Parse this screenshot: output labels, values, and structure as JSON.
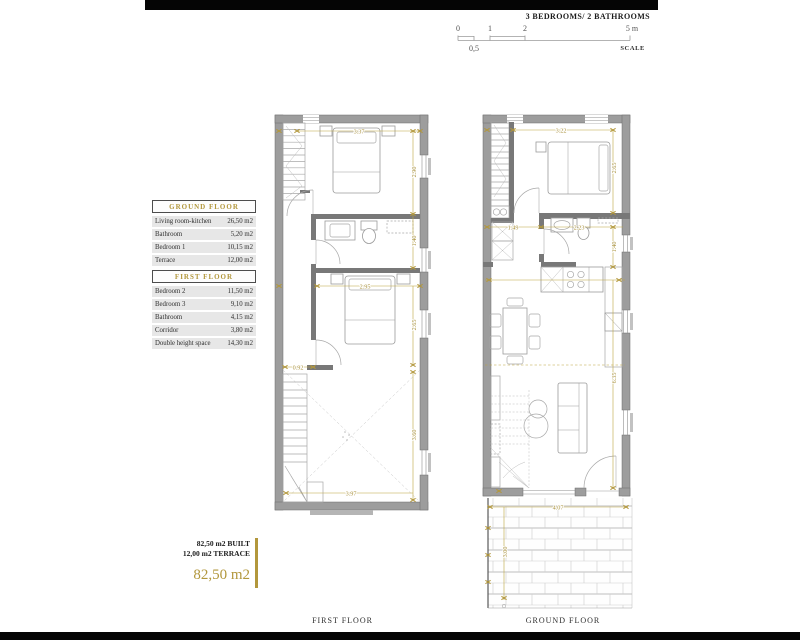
{
  "header": {
    "title": "3 BEDROOMS/ 2 BATHROOMS",
    "scale": {
      "t0": "0",
      "t1": "1",
      "t2": "2",
      "t5": "5 m",
      "half": "0,5",
      "label": "SCALE"
    }
  },
  "area_tables": [
    {
      "title": "GROUND FLOOR",
      "rows": [
        {
          "room": "Living room-kitchen",
          "area": "26,50 m2"
        },
        {
          "room": "Bathroom",
          "area": "5,20 m2"
        },
        {
          "room": "Bedroom 1",
          "area": "10,15 m2"
        },
        {
          "room": "Terrace",
          "area": "12,00 m2"
        }
      ]
    },
    {
      "title": "FIRST FLOOR",
      "rows": [
        {
          "room": "Bedroom 2",
          "area": "11,50 m2"
        },
        {
          "room": "Bedroom 3",
          "area": "9,10 m2"
        },
        {
          "room": "Bathroom",
          "area": "4,15 m2"
        },
        {
          "room": "Corridor",
          "area": "3,80 m2"
        },
        {
          "room": "Double height space",
          "area": "14,30 m2"
        }
      ]
    }
  ],
  "summary": {
    "built": "82,50 m2 BUILT",
    "terrace": "12,00 m2 TERRACE",
    "total": "82,50 m2"
  },
  "plans": {
    "first": {
      "label": "FIRST FLOOR",
      "dims": {
        "top": "3.37",
        "bed2_h": "2.90",
        "bath_h": "1.40",
        "bed3_w": "2.95",
        "bed3_h": "2.65",
        "corridor_w": "0.92",
        "void_h": "3.60",
        "void_w": "3.97"
      }
    },
    "ground": {
      "label": "GROUND FLOOR",
      "dims": {
        "top": "3.22",
        "bed1_h": "2.65",
        "hall_w": "1.49",
        "bath_w": "2.23",
        "bath_h": "1.40",
        "living_h": "6.35",
        "terrace_w": "4.07",
        "terrace_h": "3.00"
      }
    }
  },
  "colors": {
    "accent_gold": "#b2973c",
    "dim_gold": "#bda43f",
    "wall_grey": "#9d9d9d",
    "bar_black": "#050505"
  }
}
